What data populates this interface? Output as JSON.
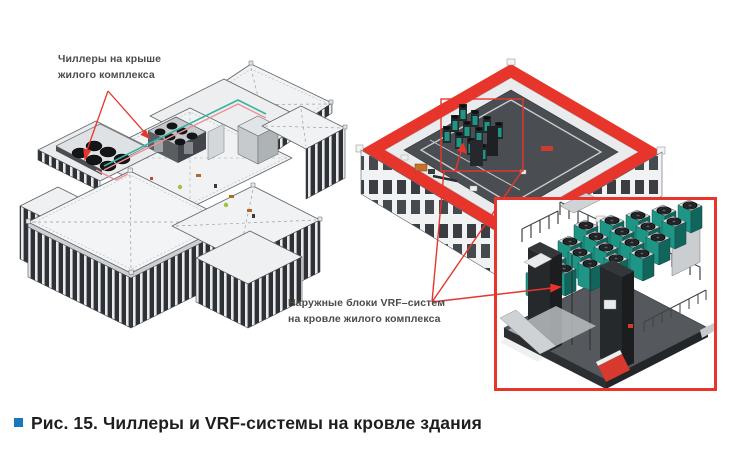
{
  "figure": {
    "left_annotation": {
      "lines": [
        "Чиллеры на крыше",
        "жилого комплекса"
      ]
    },
    "right_annotation": {
      "lines": [
        "Наружные блоки VRF–систем",
        "на кровле жилого комплекса"
      ]
    },
    "caption": "Рис. 15. Чиллеры и VRF-системы на кровле здания",
    "colors": {
      "annotation_red": "#e8352c",
      "vrf_teal": "#1e9585",
      "bullet_blue": "#1878be",
      "roof_dark": "#4a4e52",
      "roof_light": "#f0f2f3",
      "facade_dark": "#2e3236",
      "label_text": "#4b4b49",
      "caption_text": "#1e1e1c"
    }
  }
}
